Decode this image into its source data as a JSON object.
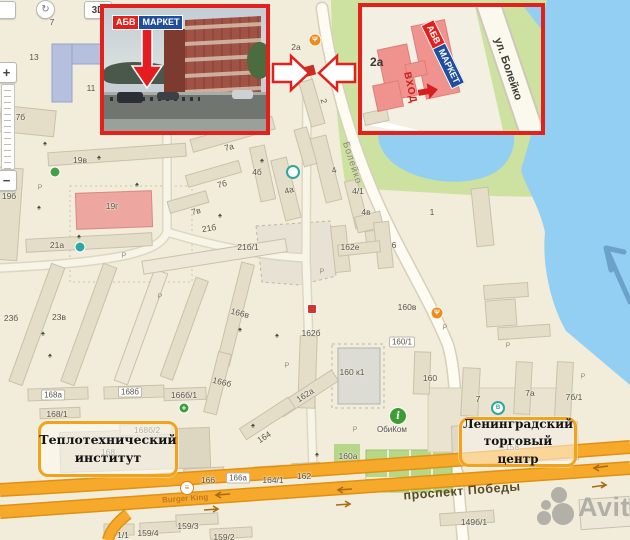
{
  "controls": {
    "three_d": "3D",
    "zoom_in": "+",
    "zoom_out": "−"
  },
  "brand": {
    "part1": "АБВ",
    "part2": "МАРКЕТ"
  },
  "insets": {
    "map": {
      "number": "2а",
      "entrance": "ВХОД"
    }
  },
  "streets": {
    "boleyko_main": "Болейко",
    "boleyko_inset": "ул. Болейко",
    "pobedy": "проспект Победы"
  },
  "poi": {
    "burger_king": "Burger King",
    "obikom": "ОбиКом"
  },
  "watermark": {
    "text": "Avito"
  },
  "callouts": {
    "institute": {
      "line1": "Теплотехнический",
      "line2": "институт"
    },
    "trade_center": {
      "line1": "Ленинградский",
      "line2": "торговый центр"
    }
  },
  "building_labels": [
    {
      "t": "7",
      "x": 52,
      "y": 22
    },
    {
      "t": "13",
      "x": 34,
      "y": 57
    },
    {
      "t": "11",
      "x": 91,
      "y": 88
    },
    {
      "t": "17б",
      "x": 18,
      "y": 117
    },
    {
      "t": "19в",
      "x": 80,
      "y": 160
    },
    {
      "t": "19б",
      "x": 9,
      "y": 196
    },
    {
      "t": "19г",
      "x": 112,
      "y": 206
    },
    {
      "t": "21а",
      "x": 57,
      "y": 245
    },
    {
      "t": "23б",
      "x": 11,
      "y": 318
    },
    {
      "t": "23в",
      "x": 59,
      "y": 317
    },
    {
      "t": "21б",
      "x": 209,
      "y": 228,
      "r": -9
    },
    {
      "t": "21б/1",
      "x": 248,
      "y": 247
    },
    {
      "t": "7а",
      "x": 229,
      "y": 147,
      "r": -15
    },
    {
      "t": "7б",
      "x": 222,
      "y": 184,
      "r": -15
    },
    {
      "t": "7в",
      "x": 196,
      "y": 211,
      "r": -15
    },
    {
      "t": "4б",
      "x": 257,
      "y": 172
    },
    {
      "t": "4а",
      "x": 289,
      "y": 190,
      "r": -15
    },
    {
      "t": "4",
      "x": 334,
      "y": 170,
      "r": -15
    },
    {
      "t": "4/1",
      "x": 358,
      "y": 191
    },
    {
      "t": "4в",
      "x": 366,
      "y": 212
    },
    {
      "t": "2а",
      "x": 296,
      "y": 47
    },
    {
      "t": "2",
      "x": 324,
      "y": 101,
      "r": 75
    },
    {
      "t": "1",
      "x": 432,
      "y": 212
    },
    {
      "t": "6",
      "x": 394,
      "y": 245
    },
    {
      "t": "162е",
      "x": 350,
      "y": 247
    },
    {
      "t": "160в",
      "x": 407,
      "y": 307
    },
    {
      "t": "162б",
      "x": 311,
      "y": 333
    },
    {
      "t": "166в",
      "x": 240,
      "y": 313,
      "r": 14
    },
    {
      "t": "166б",
      "x": 222,
      "y": 382,
      "r": 14
    },
    {
      "t": "162а",
      "x": 305,
      "y": 395,
      "r": -33
    },
    {
      "t": "164",
      "x": 264,
      "y": 437,
      "r": -33
    },
    {
      "t": "160 к1",
      "x": 352,
      "y": 372
    },
    {
      "t": "160/1",
      "x": 402,
      "y": 342,
      "box": true
    },
    {
      "t": "160а",
      "x": 348,
      "y": 456
    },
    {
      "t": "160",
      "x": 430,
      "y": 378
    },
    {
      "t": "7",
      "x": 478,
      "y": 399
    },
    {
      "t": "7а",
      "x": 530,
      "y": 393
    },
    {
      "t": "7б/1",
      "x": 574,
      "y": 397
    },
    {
      "t": "158",
      "x": 512,
      "y": 447
    },
    {
      "t": "168а",
      "x": 53,
      "y": 395,
      "box": true
    },
    {
      "t": "168б",
      "x": 130,
      "y": 392,
      "box": true
    },
    {
      "t": "166б/1",
      "x": 184,
      "y": 395
    },
    {
      "t": "168/1",
      "x": 57,
      "y": 414
    },
    {
      "t": "168б/2",
      "x": 147,
      "y": 430
    },
    {
      "t": "168",
      "x": 108,
      "y": 452
    },
    {
      "t": "166",
      "x": 208,
      "y": 480
    },
    {
      "t": "166а",
      "x": 238,
      "y": 478,
      "box": true
    },
    {
      "t": "164/1",
      "x": 273,
      "y": 480
    },
    {
      "t": "162",
      "x": 304,
      "y": 476
    },
    {
      "t": "1/1",
      "x": 123,
      "y": 535
    },
    {
      "t": "159/4",
      "x": 148,
      "y": 533
    },
    {
      "t": "159/3",
      "x": 188,
      "y": 526
    },
    {
      "t": "159/2",
      "x": 224,
      "y": 537
    },
    {
      "t": "149б/1",
      "x": 474,
      "y": 522
    }
  ],
  "trees": [
    {
      "x": 45,
      "y": 144
    },
    {
      "x": 99,
      "y": 158
    },
    {
      "x": 39,
      "y": 208
    },
    {
      "x": 79,
      "y": 237
    },
    {
      "x": 262,
      "y": 161
    },
    {
      "x": 220,
      "y": 216
    },
    {
      "x": 43,
      "y": 334
    },
    {
      "x": 50,
      "y": 356
    },
    {
      "x": 277,
      "y": 336
    },
    {
      "x": 253,
      "y": 426
    },
    {
      "x": 317,
      "y": 455
    },
    {
      "x": 188,
      "y": 57
    },
    {
      "x": 137,
      "y": 185
    },
    {
      "x": 240,
      "y": 330
    }
  ],
  "parkings": [
    {
      "x": 40,
      "y": 188
    },
    {
      "x": 124,
      "y": 256
    },
    {
      "x": 262,
      "y": 120
    },
    {
      "x": 322,
      "y": 272
    },
    {
      "x": 445,
      "y": 328
    },
    {
      "x": 508,
      "y": 346
    },
    {
      "x": 583,
      "y": 377
    },
    {
      "x": 355,
      "y": 430
    },
    {
      "x": 287,
      "y": 366
    },
    {
      "x": 160,
      "y": 297
    }
  ],
  "icons": [
    {
      "type": "food",
      "x": 315,
      "y": 40,
      "glyph": "Ψ"
    },
    {
      "type": "food",
      "x": 437,
      "y": 313,
      "glyph": "Ψ"
    },
    {
      "type": "sign-green",
      "x": 55,
      "y": 172,
      "glyph": ""
    },
    {
      "type": "sign-teal",
      "x": 80,
      "y": 247,
      "glyph": ""
    },
    {
      "type": "stop",
      "x": 293,
      "y": 172,
      "glyph": ""
    },
    {
      "type": "stop",
      "x": 498,
      "y": 408,
      "glyph": "В"
    },
    {
      "type": "pharmacy",
      "x": 184,
      "y": 408,
      "glyph": "+"
    },
    {
      "type": "monument",
      "x": 13,
      "y": 171,
      "glyph": "▲"
    },
    {
      "type": "shop-red",
      "x": 312,
      "y": 309,
      "glyph": ""
    }
  ]
}
